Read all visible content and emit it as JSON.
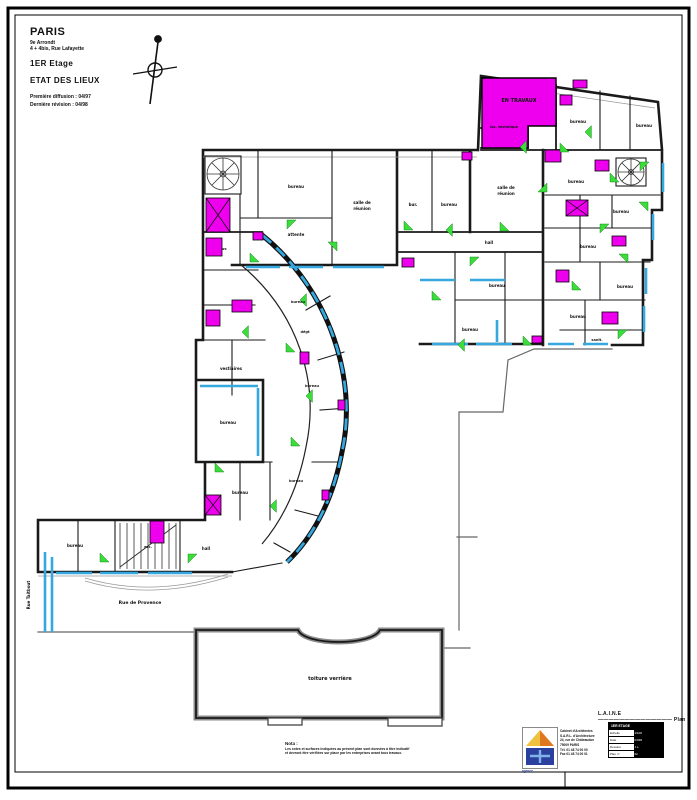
{
  "title_block": {
    "city": "PARIS",
    "district": "9e Arrondt",
    "address": "4 + 4bis, Rue Lafayette",
    "floor": "1ER  Etage",
    "status": "ETAT DES LIEUX",
    "rev1": "Première diffusion : 04/97",
    "rev2": "Dernière révision : 04/98"
  },
  "colors": {
    "wall": "#1a1a1a",
    "gray": "#666666",
    "hl": "#ee00ee",
    "win": "#35a8e0",
    "door": "#3ddc3d",
    "logo_a": "#f0c040",
    "logo_b": "#e07820",
    "logo_c": "#2b3f9e"
  },
  "plan": {
    "labels": [
      {
        "t": "bureau",
        "x": 296,
        "y": 188
      },
      {
        "t": "attente",
        "x": 296,
        "y": 236
      },
      {
        "t": "salle de",
        "x": 362,
        "y": 204
      },
      {
        "t": "réunion",
        "x": 362,
        "y": 210
      },
      {
        "t": "bur.",
        "x": 413,
        "y": 206
      },
      {
        "t": "bureau",
        "x": 449,
        "y": 206
      },
      {
        "t": "salle de",
        "x": 506,
        "y": 189
      },
      {
        "t": "réunion",
        "x": 506,
        "y": 195
      },
      {
        "t": "EN TRAVAUX",
        "x": 519,
        "y": 102,
        "s": 5
      },
      {
        "t": "loc. technique",
        "x": 504,
        "y": 128,
        "s": 3.5
      },
      {
        "t": "bureau",
        "x": 578,
        "y": 123
      },
      {
        "t": "bureau",
        "x": 644,
        "y": 127
      },
      {
        "t": "bureau",
        "x": 576,
        "y": 183
      },
      {
        "t": "bureau",
        "x": 621,
        "y": 213
      },
      {
        "t": "bureau",
        "x": 588,
        "y": 248
      },
      {
        "t": "bureau",
        "x": 625,
        "y": 288
      },
      {
        "t": "bureau",
        "x": 578,
        "y": 318
      },
      {
        "t": "sanit.",
        "x": 597,
        "y": 341,
        "s": 3.5
      },
      {
        "t": "hall",
        "x": 489,
        "y": 244
      },
      {
        "t": "bureau",
        "x": 497,
        "y": 287
      },
      {
        "t": "bureau",
        "x": 470,
        "y": 331
      },
      {
        "t": "bureau",
        "x": 298,
        "y": 303,
        "s": 3.5
      },
      {
        "t": "dégt",
        "x": 305,
        "y": 333,
        "s": 3.5
      },
      {
        "t": "bureau",
        "x": 312,
        "y": 387,
        "s": 3.5
      },
      {
        "t": "bureau",
        "x": 296,
        "y": 482,
        "s": 3.5
      },
      {
        "t": "vestiaires",
        "x": 231,
        "y": 370
      },
      {
        "t": "bureau",
        "x": 228,
        "y": 424
      },
      {
        "t": "bureau",
        "x": 240,
        "y": 494
      },
      {
        "t": "wc",
        "x": 224,
        "y": 250,
        "s": 3.5
      },
      {
        "t": "bureau",
        "x": 75,
        "y": 547
      },
      {
        "t": "esc.",
        "x": 148,
        "y": 548,
        "s": 3.5
      },
      {
        "t": "hall",
        "x": 206,
        "y": 550
      },
      {
        "t": "toiture verrière",
        "x": 330,
        "y": 680,
        "s": 5
      },
      {
        "t": "Rue de Provence",
        "x": 140,
        "y": 604,
        "s": 4.5
      },
      {
        "t": "Rue Taitbout",
        "x": 30,
        "y": 595,
        "s": 4,
        "r": -90
      }
    ],
    "highlights": [
      {
        "x": 206,
        "y": 198,
        "w": 24,
        "h": 34,
        "cross": true
      },
      {
        "x": 206,
        "y": 238,
        "w": 16,
        "h": 18
      },
      {
        "x": 206,
        "y": 310,
        "w": 14,
        "h": 16
      },
      {
        "x": 232,
        "y": 300,
        "w": 20,
        "h": 12
      },
      {
        "x": 150,
        "y": 521,
        "w": 14,
        "h": 22
      },
      {
        "x": 205,
        "y": 495,
        "w": 16,
        "h": 20,
        "cross": true
      },
      {
        "x": 560,
        "y": 95,
        "w": 12,
        "h": 10
      },
      {
        "x": 573,
        "y": 80,
        "w": 14,
        "h": 8
      },
      {
        "x": 595,
        "y": 160,
        "w": 14,
        "h": 11
      },
      {
        "x": 566,
        "y": 200,
        "w": 22,
        "h": 16,
        "cross": true
      },
      {
        "x": 612,
        "y": 236,
        "w": 14,
        "h": 10
      },
      {
        "x": 556,
        "y": 270,
        "w": 13,
        "h": 12
      },
      {
        "x": 602,
        "y": 312,
        "w": 16,
        "h": 12
      },
      {
        "x": 545,
        "y": 150,
        "w": 16,
        "h": 12
      },
      {
        "x": 402,
        "y": 258,
        "w": 12,
        "h": 9
      },
      {
        "x": 532,
        "y": 336,
        "w": 10,
        "h": 7
      },
      {
        "x": 300,
        "y": 352,
        "w": 9,
        "h": 12
      },
      {
        "x": 338,
        "y": 400,
        "w": 7,
        "h": 10
      },
      {
        "x": 322,
        "y": 490,
        "w": 7,
        "h": 10
      },
      {
        "x": 253,
        "y": 232,
        "w": 10,
        "h": 8
      },
      {
        "x": 462,
        "y": 152,
        "w": 10,
        "h": 8
      }
    ],
    "windows": [
      [
        246,
        267,
        280,
        267
      ],
      [
        289,
        267,
        323,
        267
      ],
      [
        333,
        267,
        384,
        267
      ],
      [
        432,
        344,
        468,
        344
      ],
      [
        476,
        344,
        512,
        344
      ],
      [
        548,
        344,
        574,
        344
      ],
      [
        583,
        344,
        608,
        344
      ],
      [
        653,
        214,
        653,
        240
      ],
      [
        646,
        268,
        646,
        294
      ],
      [
        644,
        306,
        644,
        332
      ],
      [
        663,
        163,
        663,
        192
      ],
      [
        56,
        573,
        92,
        573
      ],
      [
        100,
        573,
        138,
        573
      ],
      [
        148,
        573,
        192,
        573
      ],
      [
        45,
        552,
        45,
        632
      ],
      [
        52,
        557,
        52,
        632
      ],
      [
        200,
        386,
        258,
        386
      ],
      [
        258,
        388,
        258,
        456
      ],
      [
        420,
        280,
        455,
        280
      ],
      [
        470,
        280,
        505,
        280
      ],
      [
        497,
        320,
        497,
        342
      ]
    ],
    "doors": [
      [
        250,
        262,
        0
      ],
      [
        287,
        220,
        90
      ],
      [
        337,
        242,
        180
      ],
      [
        404,
        230,
        0
      ],
      [
        446,
        230,
        45
      ],
      [
        500,
        231,
        0
      ],
      [
        547,
        192,
        270
      ],
      [
        600,
        224,
        90
      ],
      [
        628,
        254,
        180
      ],
      [
        572,
        290,
        0
      ],
      [
        618,
        330,
        90
      ],
      [
        648,
        202,
        180
      ],
      [
        560,
        152,
        0
      ],
      [
        520,
        147,
        45
      ],
      [
        470,
        257,
        90
      ],
      [
        432,
        300,
        0
      ],
      [
        300,
        300,
        45
      ],
      [
        286,
        352,
        0
      ],
      [
        306,
        396,
        45
      ],
      [
        291,
        446,
        0
      ],
      [
        270,
        506,
        45
      ],
      [
        100,
        562,
        0
      ],
      [
        188,
        554,
        90
      ],
      [
        215,
        472,
        0
      ],
      [
        242,
        332,
        45
      ],
      [
        610,
        182,
        0
      ],
      [
        585,
        132,
        45
      ],
      [
        640,
        162,
        90
      ],
      [
        523,
        345,
        0
      ],
      [
        458,
        345,
        45
      ]
    ]
  },
  "footer": {
    "plan_ref": "L.A.I.N.E  ——————————————  Plan",
    "note_title": "Nota :",
    "note_line1": "Les cotes et surfaces indiquées au présent plan sont données à titre indicatif",
    "note_line2": "et devront être vérifiées sur place par les entreprises avant tous travaux.",
    "logo_caption": "agence",
    "firm_lines": [
      "Cabinet d'Architectes",
      "S.A.R.L. d'Architecture",
      "24, rue de Châteaudun",
      "75009 PARIS",
      "Tél. 01 48 74 00 00",
      "Fax 01 48 74 00 01"
    ],
    "stamp": {
      "head": "1ER ETAGE",
      "rows": [
        {
          "label": "Echelle",
          "value": "1/100"
        },
        {
          "label": "Date",
          "value": "04/98"
        },
        {
          "label": "Dessiné",
          "value": "J.L."
        },
        {
          "label": "Plan n°",
          "value": "02"
        }
      ]
    }
  }
}
